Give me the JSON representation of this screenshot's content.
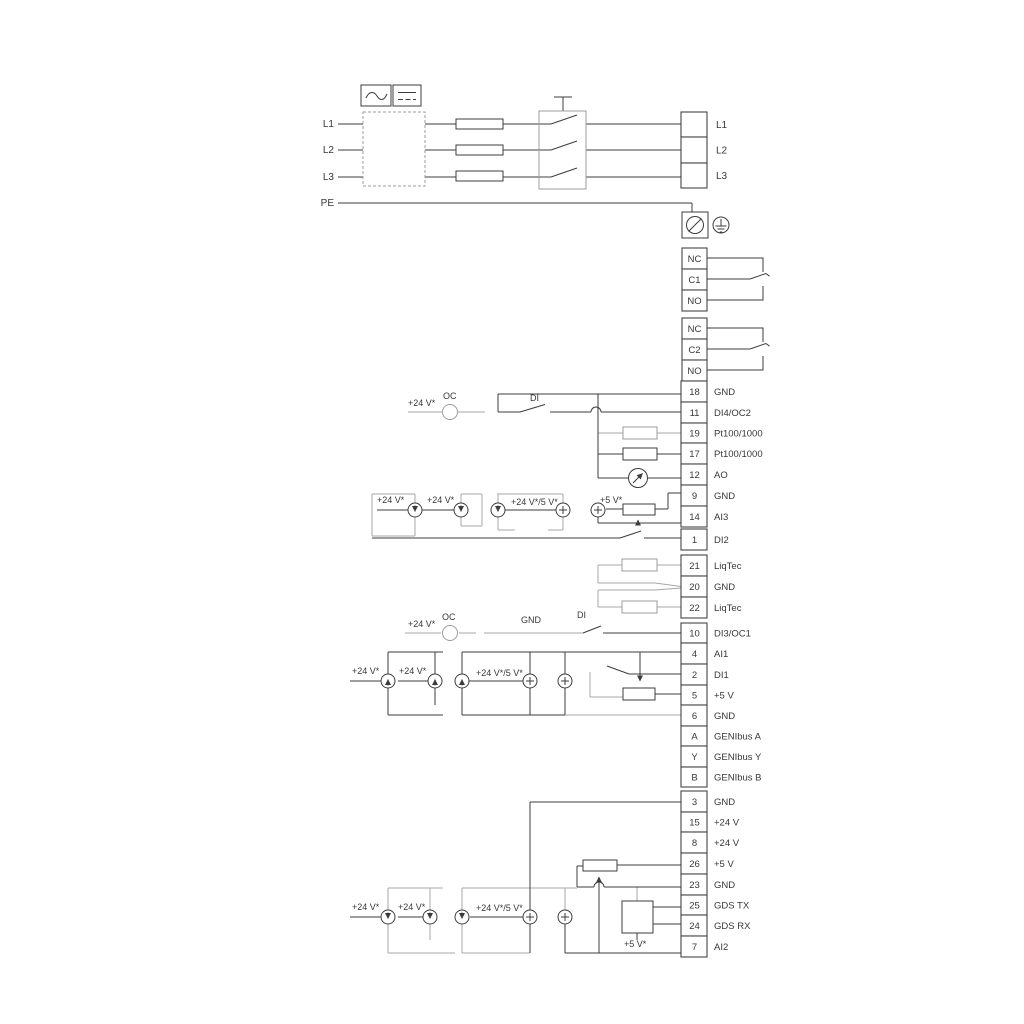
{
  "power": {
    "inputs": [
      "L1",
      "L2",
      "L3",
      "PE"
    ],
    "outputs": [
      "L1",
      "L2",
      "L3"
    ]
  },
  "relays": [
    {
      "terminals": [
        "NC",
        "C1",
        "NO"
      ]
    },
    {
      "terminals": [
        "NC",
        "C2",
        "NO"
      ]
    }
  ],
  "strips": {
    "io1": [
      {
        "n": "18",
        "t": "GND"
      },
      {
        "n": "11",
        "t": "DI4/OC2"
      },
      {
        "n": "19",
        "t": "Pt100/1000"
      },
      {
        "n": "17",
        "t": "Pt100/1000"
      },
      {
        "n": "12",
        "t": "AO"
      },
      {
        "n": "9",
        "t": "GND"
      },
      {
        "n": "14",
        "t": "AI3"
      },
      {
        "n": "1",
        "t": "DI2"
      }
    ],
    "liqtec": [
      {
        "n": "21",
        "t": "LiqTec"
      },
      {
        "n": "20",
        "t": "GND"
      },
      {
        "n": "22",
        "t": "LiqTec"
      }
    ],
    "io2": [
      {
        "n": "10",
        "t": "DI3/OC1"
      },
      {
        "n": "4",
        "t": "AI1"
      },
      {
        "n": "2",
        "t": "DI1"
      },
      {
        "n": "5",
        "t": "+5 V"
      },
      {
        "n": "6",
        "t": "GND"
      },
      {
        "n": "A",
        "t": "GENIbus A"
      },
      {
        "n": "Y",
        "t": "GENIbus Y"
      },
      {
        "n": "B",
        "t": "GENIbus B"
      }
    ],
    "io3": [
      {
        "n": "3",
        "t": "GND"
      },
      {
        "n": "15",
        "t": "+24 V"
      },
      {
        "n": "8",
        "t": "+24 V"
      },
      {
        "n": "26",
        "t": "+5 V"
      },
      {
        "n": "23",
        "t": "GND"
      },
      {
        "n": "25",
        "t": "GDS TX"
      },
      {
        "n": "24",
        "t": "GDS RX"
      },
      {
        "n": "7",
        "t": "AI2"
      }
    ]
  },
  "annotations": [
    {
      "text": "+24 V*"
    },
    {
      "text": "OC"
    },
    {
      "text": "DI"
    },
    {
      "text": "+24 V*"
    },
    {
      "text": "+24 V*"
    },
    {
      "text": "+24 V*/5 V*"
    },
    {
      "text": "+5 V*"
    },
    {
      "text": "+24 V*"
    },
    {
      "text": "OC"
    },
    {
      "text": "GND"
    },
    {
      "text": "DI"
    },
    {
      "text": "+24 V*"
    },
    {
      "text": "+24 V*"
    },
    {
      "text": "+24 V*/5 V*"
    },
    {
      "text": "+24 V*"
    },
    {
      "text": "+24 V*"
    },
    {
      "text": "+24 V*/5 V*"
    },
    {
      "text": "+5 V*"
    }
  ],
  "icons": {
    "ac": "ac-wave-icon",
    "dc": "dc-icon",
    "fuse": "fuse-icon",
    "switch": "mains-switch-icon",
    "pe": "protective-earth-terminal-icon",
    "ground": "ground-icon",
    "current_source": "current-source-icon",
    "voltage_source": "voltage-source-icon",
    "open_collector": "open-collector-icon",
    "resistor": "resistor-icon",
    "potentiometer": "potentiometer-icon",
    "meter": "analog-meter-icon",
    "sensor": "gds-sensor-box-icon"
  },
  "colors": {
    "line_dark": "#3c3c3e",
    "line_grey": "#a6a7a9",
    "background": "#ffffff"
  }
}
